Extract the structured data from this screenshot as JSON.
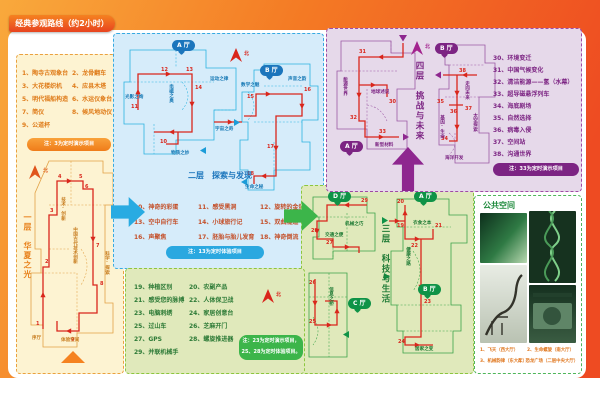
{
  "title": "经典参观路线（约2小时）",
  "compass_n": "北",
  "colors": {
    "orange": "#f58220",
    "blue": "#29abe2",
    "green": "#3cb54a",
    "purple": "#7c2483",
    "route_red": "#d9261c"
  },
  "floor1": {
    "name": "一层　华夏之光",
    "items": [
      "1、陶寺古观象台",
      "2、龙骨翻车",
      "3、大花楼织机",
      "4、应县木塔",
      "5、明代福船构造",
      "6、水运仪象台",
      "7、简仪",
      "8、候风地动仪",
      "9、公道杯"
    ],
    "note": "注：3为定时演示项目",
    "stops": [
      "1",
      "2",
      "3",
      "4",
      "5",
      "6",
      "7",
      "8",
      "9"
    ],
    "labels": {
      "zone_left": "技术·创新",
      "zone_center": "中国古代技术创新",
      "zone_right": "科学·探索",
      "xuting": "序厅",
      "space": "体验空间"
    }
  },
  "floor2": {
    "name": "二层　探索与发现",
    "hall_a": "A 厅",
    "hall_b": "B 厅",
    "zones": {
      "yundong": "运动之律",
      "guangying": "光影之绚",
      "dianci": "电磁之奥",
      "yuzhou": "宇宙之奇",
      "wuzhi": "物质之妙",
      "shuxue": "数学之魅",
      "shengyin": "声音之韵",
      "shengming": "生命之秘"
    },
    "items": [
      "10、神奇的彩蛋",
      "11、感受黑洞",
      "12、旋转的金蛋",
      "13、空中自行车",
      "14、小球旅行记",
      "15、双曲隧道",
      "16、声聚焦",
      "17、胚胎与胎儿发育",
      "18、神奇倒流"
    ],
    "note": "注：13为定时体验项目",
    "stops_a": [
      "10",
      "11",
      "12",
      "13",
      "14"
    ],
    "stops_b": [
      "15",
      "16",
      "17",
      "18"
    ]
  },
  "floor3": {
    "name": "三层　科技与生活",
    "halls": {
      "a": "A 厅",
      "b": "B 厅",
      "c": "C 厅",
      "d": "D 厅"
    },
    "zones": {
      "yishi": "衣食之本",
      "jiankang": "健康之路",
      "jujia": "居家之变",
      "xinxi": "信息之桥",
      "jiaotong": "交通之便",
      "jixie": "机械之巧"
    },
    "items": [
      "19、种植区别",
      "20、农副产品",
      "21、感受您的脉搏",
      "22、人体保卫战",
      "23、电脑刺绣",
      "24、家居创意台",
      "25、过山车",
      "26、芝麻开门",
      "27、GPS",
      "28、螺旋推进器",
      "29、并联机械手"
    ],
    "note_line1": "注：23为定时演示项目，",
    "note_line2": "25、28为定时体验项目。",
    "stops_d": [
      "27",
      "28",
      "29"
    ],
    "stops_ab": [
      "19",
      "20",
      "21",
      "22",
      "23",
      "24"
    ],
    "stops_c": [
      "25",
      "26"
    ]
  },
  "floor4": {
    "name": "四层　挑战与未来",
    "hall_a": "A 厅",
    "hall_b": "B 厅",
    "zones": {
      "nengyuan": "能源世界",
      "diqiu": "地球述说",
      "xinxing": "新型材料",
      "zouxiang": "走向未来",
      "jiyin": "基因·生命",
      "taikong": "太空探索",
      "haiyang": "海洋开发"
    },
    "items": [
      "30、环境变迁",
      "31、中国气候变化",
      "32、清洁能源——氢（水幕）",
      "33、超导磁悬浮列车",
      "34、海底剧场",
      "35、自然选择",
      "36、病毒入侵",
      "37、空间站",
      "38、沟通世界"
    ],
    "note": "注：33为定时演示项目",
    "stops_a": [
      "30",
      "31",
      "32",
      "33"
    ],
    "stops_b": [
      "34",
      "35",
      "36",
      "37",
      "38"
    ]
  },
  "public": {
    "title": "公共空间",
    "captions": [
      "1、飞天（西大厅）",
      "2、生命螺旋（南大厅）",
      "3、机械韵律（东大厅）",
      "4、恐龙广场（二层中央大厅）"
    ]
  }
}
